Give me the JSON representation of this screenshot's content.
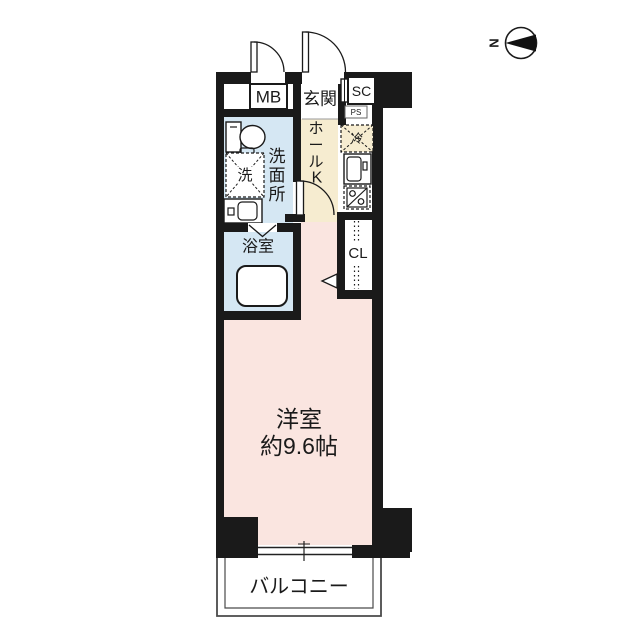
{
  "compass": {
    "north_label": "N"
  },
  "labels": {
    "meter_box": "MB",
    "entrance": "玄関",
    "shoe_closet": "SC",
    "pipe_space": "PS",
    "hall": "ホール",
    "kitchen": "K",
    "refrigerator": "冷",
    "washroom": "洗面所",
    "washer": "洗",
    "bathroom": "浴室",
    "closet": "CL",
    "main_room_name": "洋室",
    "main_room_size": "約9.6帖",
    "balcony": "バルコニー"
  },
  "colors": {
    "wall": "#1a1a1a",
    "room_pink": "#fae5e0",
    "water_blue": "#d5e7f3",
    "hall_cream": "#f6ecd0"
  }
}
